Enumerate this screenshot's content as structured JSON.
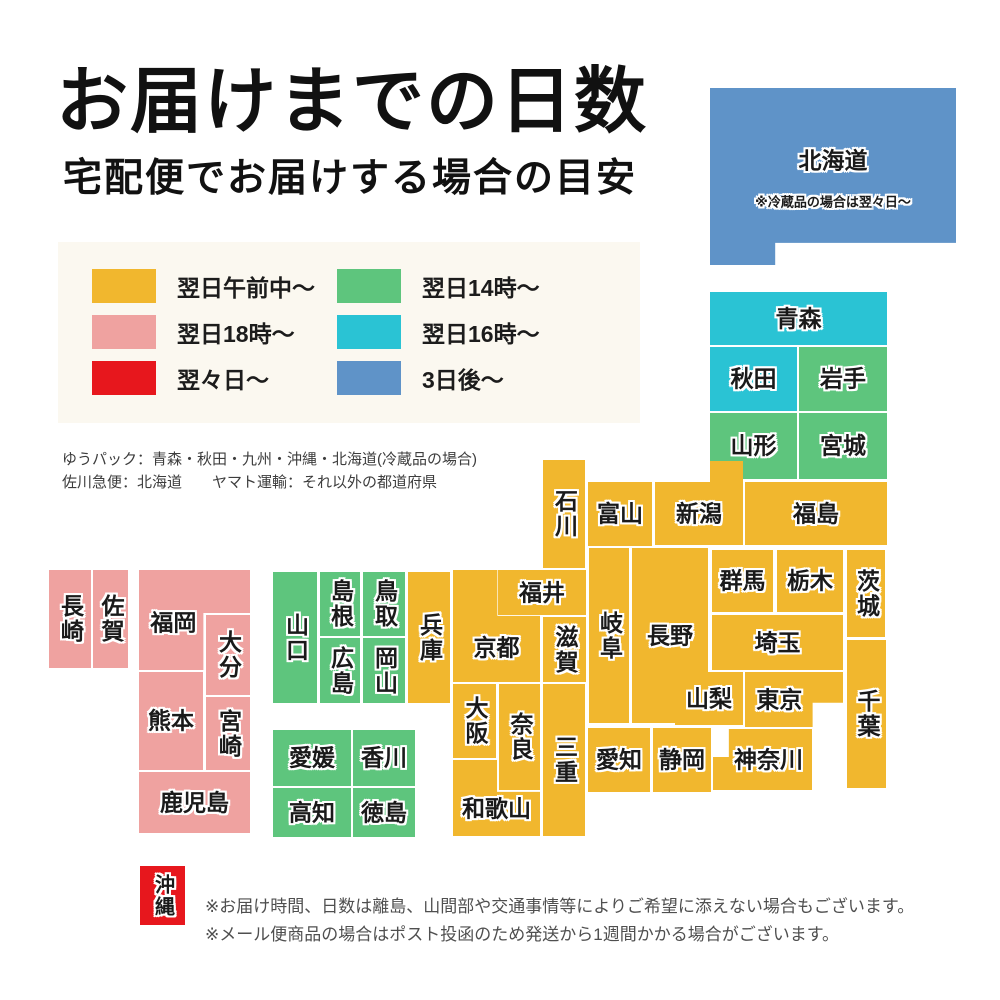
{
  "header": {
    "title": "お届けまでの日数",
    "subtitle": "宅配便でお届けする場合の目安"
  },
  "colors": {
    "next_day_morning": "#f1b72e",
    "next_day_18": "#efa2a0",
    "two_days_later": "#e7171d",
    "next_day_14": "#5ec57d",
    "next_day_16": "#2ac3d4",
    "three_days_later": "#5f93c8",
    "legend_background": "#fbf8f0"
  },
  "legend": {
    "columns": [
      {
        "items": [
          {
            "label": "翌日午前中〜",
            "color": "next_day_morning"
          },
          {
            "label": "翌日18時〜",
            "color": "next_day_18"
          },
          {
            "label": "翌々日〜",
            "color": "two_days_later"
          }
        ]
      },
      {
        "items": [
          {
            "label": "翌日14時〜",
            "color": "next_day_14"
          },
          {
            "label": "翌日16時〜",
            "color": "next_day_16"
          },
          {
            "label": "3日後〜",
            "color": "three_days_later"
          }
        ]
      }
    ]
  },
  "carrier_notes": {
    "line1": "ゆうパック：青森・秋田・九州・沖縄・北海道(冷蔵品の場合)",
    "line2": "佐川急便：北海道　　ヤマト運輸：それ以外の都道府県"
  },
  "map": {
    "prefectures": [
      {
        "id": "hokkaido",
        "name": "北海道",
        "x": 710,
        "y": 88,
        "w": 246,
        "h": 177,
        "color": "three_days_later",
        "clip": "polygon(0% 0%, 100% 0%, 100% 87.5%, 26.5% 87.5%, 26.5% 100%, 0% 100%)",
        "ly": 41,
        "note": "※冷蔵品の場合は翌々日〜",
        "note_ly": 64
      },
      {
        "id": "aomori",
        "name": "青森",
        "x": 710,
        "y": 292,
        "w": 177,
        "h": 53,
        "color": "next_day_16"
      },
      {
        "id": "akita",
        "name": "秋田",
        "x": 710,
        "y": 347,
        "w": 87,
        "h": 64,
        "color": "next_day_16"
      },
      {
        "id": "iwate",
        "name": "岩手",
        "x": 799,
        "y": 347,
        "w": 88,
        "h": 64,
        "color": "next_day_14"
      },
      {
        "id": "yamagata",
        "name": "山形",
        "x": 710,
        "y": 413,
        "w": 87,
        "h": 66,
        "color": "next_day_14"
      },
      {
        "id": "miyagi",
        "name": "宮城",
        "x": 799,
        "y": 413,
        "w": 88,
        "h": 66,
        "color": "next_day_14"
      },
      {
        "id": "ishikawa",
        "name": "石川",
        "x": 543,
        "y": 460,
        "w": 42,
        "h": 108,
        "color": "next_day_morning",
        "vertical": true
      },
      {
        "id": "toyama",
        "name": "富山",
        "x": 588,
        "y": 482,
        "w": 64,
        "h": 64,
        "color": "next_day_morning"
      },
      {
        "id": "niigata",
        "name": "新潟",
        "x": 655,
        "y": 461,
        "w": 88,
        "h": 84,
        "color": "next_day_morning",
        "clip": "polygon(0% 25%, 62.5% 25%, 62.5% 0%, 100% 0%, 100% 100%, 0% 100%)",
        "ly": 63
      },
      {
        "id": "fukushima",
        "name": "福島",
        "x": 745,
        "y": 482,
        "w": 142,
        "h": 63,
        "color": "next_day_morning"
      },
      {
        "id": "fukui",
        "name": "福井",
        "x": 498,
        "y": 570,
        "w": 88,
        "h": 45,
        "color": "next_day_morning"
      },
      {
        "id": "kyoto",
        "name": "京都",
        "x": 453,
        "y": 570,
        "w": 87,
        "h": 112,
        "color": "next_day_morning",
        "clip": "polygon(0% 0%, 51% 0%, 51% 41%, 100% 41%, 100% 100%, 0% 100%)",
        "ly": 70
      },
      {
        "id": "shiga",
        "name": "滋賀",
        "x": 543,
        "y": 617,
        "w": 43,
        "h": 65,
        "color": "next_day_morning",
        "vertical": true
      },
      {
        "id": "hyogo",
        "name": "兵庫",
        "x": 408,
        "y": 572,
        "w": 42,
        "h": 131,
        "color": "next_day_morning",
        "vertical": true
      },
      {
        "id": "gifu",
        "name": "岐阜",
        "x": 589,
        "y": 548,
        "w": 40,
        "h": 175,
        "color": "next_day_morning",
        "vertical": true
      },
      {
        "id": "nagano",
        "name": "長野",
        "x": 632,
        "y": 548,
        "w": 76,
        "h": 175,
        "color": "next_day_morning"
      },
      {
        "id": "gunma",
        "name": "群馬",
        "x": 712,
        "y": 550,
        "w": 61,
        "h": 62,
        "color": "next_day_morning"
      },
      {
        "id": "tochigi",
        "name": "栃木",
        "x": 777,
        "y": 550,
        "w": 66,
        "h": 62,
        "color": "next_day_morning"
      },
      {
        "id": "ibaraki",
        "name": "茨城",
        "x": 847,
        "y": 550,
        "w": 38,
        "h": 87,
        "color": "next_day_morning",
        "vertical": true
      },
      {
        "id": "saitama",
        "name": "埼玉",
        "x": 712,
        "y": 615,
        "w": 131,
        "h": 55,
        "color": "next_day_morning"
      },
      {
        "id": "yamanashi",
        "name": "山梨",
        "x": 675,
        "y": 672,
        "w": 68,
        "h": 53,
        "color": "next_day_morning"
      },
      {
        "id": "tokyo",
        "name": "東京",
        "x": 745,
        "y": 672,
        "w": 98,
        "h": 55,
        "color": "next_day_morning",
        "clip": "polygon(0% 0%, 100% 0%, 100% 56%, 69% 56%, 69% 100%, 0% 100%)",
        "lx": 35
      },
      {
        "id": "chiba",
        "name": "千葉",
        "x": 847,
        "y": 640,
        "w": 39,
        "h": 148,
        "color": "next_day_morning",
        "vertical": true
      },
      {
        "id": "kanagawa",
        "name": "神奈川",
        "x": 713,
        "y": 729,
        "w": 99,
        "h": 61,
        "color": "next_day_morning",
        "clip": "polygon(16% 0%, 100% 0%, 100% 100%, 0% 100%, 0% 46%, 16% 46%)",
        "lx": 56
      },
      {
        "id": "shizuoka",
        "name": "静岡",
        "x": 653,
        "y": 728,
        "w": 58,
        "h": 64,
        "color": "next_day_morning"
      },
      {
        "id": "aichi",
        "name": "愛知",
        "x": 588,
        "y": 728,
        "w": 62,
        "h": 64,
        "color": "next_day_morning"
      },
      {
        "id": "osaka",
        "name": "大阪",
        "x": 453,
        "y": 684,
        "w": 43,
        "h": 74,
        "color": "next_day_morning",
        "vertical": true
      },
      {
        "id": "nara",
        "name": "奈良",
        "x": 499,
        "y": 684,
        "w": 41,
        "h": 106,
        "color": "next_day_morning",
        "vertical": true
      },
      {
        "id": "wakayama",
        "name": "和歌山",
        "x": 453,
        "y": 760,
        "w": 87,
        "h": 76,
        "color": "next_day_morning",
        "clip": "polygon(0% 0%, 50.6% 0%, 50.6% 42%, 100% 42%, 100% 100%, 0% 100%)",
        "ly": 64
      },
      {
        "id": "mie",
        "name": "三重",
        "x": 543,
        "y": 684,
        "w": 42,
        "h": 152,
        "color": "next_day_morning",
        "vertical": true
      },
      {
        "id": "yamaguchi",
        "name": "山口",
        "x": 273,
        "y": 572,
        "w": 44,
        "h": 131,
        "color": "next_day_14",
        "vertical": true
      },
      {
        "id": "shimane",
        "name": "島根",
        "x": 320,
        "y": 572,
        "w": 40,
        "h": 64,
        "color": "next_day_14",
        "vertical": true
      },
      {
        "id": "hiroshima",
        "name": "広島",
        "x": 320,
        "y": 638,
        "w": 40,
        "h": 65,
        "color": "next_day_14",
        "vertical": true
      },
      {
        "id": "tottori",
        "name": "鳥取",
        "x": 363,
        "y": 572,
        "w": 42,
        "h": 64,
        "color": "next_day_14",
        "vertical": true
      },
      {
        "id": "okayama",
        "name": "岡山",
        "x": 363,
        "y": 638,
        "w": 42,
        "h": 65,
        "color": "next_day_14",
        "vertical": true
      },
      {
        "id": "ehime",
        "name": "愛媛",
        "x": 273,
        "y": 730,
        "w": 78,
        "h": 56,
        "color": "next_day_14"
      },
      {
        "id": "kagawa",
        "name": "香川",
        "x": 353,
        "y": 730,
        "w": 62,
        "h": 56,
        "color": "next_day_14"
      },
      {
        "id": "kochi",
        "name": "高知",
        "x": 273,
        "y": 788,
        "w": 78,
        "h": 49,
        "color": "next_day_14"
      },
      {
        "id": "tokushima",
        "name": "徳島",
        "x": 353,
        "y": 788,
        "w": 62,
        "h": 49,
        "color": "next_day_14"
      },
      {
        "id": "nagasaki",
        "name": "長崎",
        "x": 49,
        "y": 570,
        "w": 42,
        "h": 98,
        "color": "next_day_18",
        "vertical": true
      },
      {
        "id": "saga",
        "name": "佐賀",
        "x": 93,
        "y": 570,
        "w": 35,
        "h": 98,
        "color": "next_day_18",
        "vertical": true
      },
      {
        "id": "fukuoka",
        "name": "福岡",
        "x": 139,
        "y": 570,
        "w": 111,
        "h": 100,
        "color": "next_day_18",
        "clip": "polygon(0% 0%, 100% 0%, 100% 43%, 58% 43%, 58% 100%, 0% 100%)",
        "lx": 31,
        "ly": 53
      },
      {
        "id": "oita",
        "name": "大分",
        "x": 206,
        "y": 615,
        "w": 44,
        "h": 80,
        "color": "next_day_18",
        "vertical": true
      },
      {
        "id": "kumamoto",
        "name": "熊本",
        "x": 139,
        "y": 672,
        "w": 64,
        "h": 98,
        "color": "next_day_18"
      },
      {
        "id": "miyazaki",
        "name": "宮崎",
        "x": 206,
        "y": 697,
        "w": 44,
        "h": 73,
        "color": "next_day_18",
        "vertical": true
      },
      {
        "id": "kagoshima",
        "name": "鹿児島",
        "x": 139,
        "y": 772,
        "w": 111,
        "h": 61,
        "color": "next_day_18"
      },
      {
        "id": "okinawa",
        "name": "沖縄",
        "x": 140,
        "y": 866,
        "w": 45,
        "h": 59,
        "color": "two_days_later",
        "vertical": true,
        "fs": 20
      }
    ]
  },
  "footer": {
    "line1": "※お届け時間、日数は離島、山間部や交通事情等によりご希望に添えない場合もございます。",
    "line2": "※メール便商品の場合はポスト投函のため発送から1週間かかる場合がございます。"
  }
}
